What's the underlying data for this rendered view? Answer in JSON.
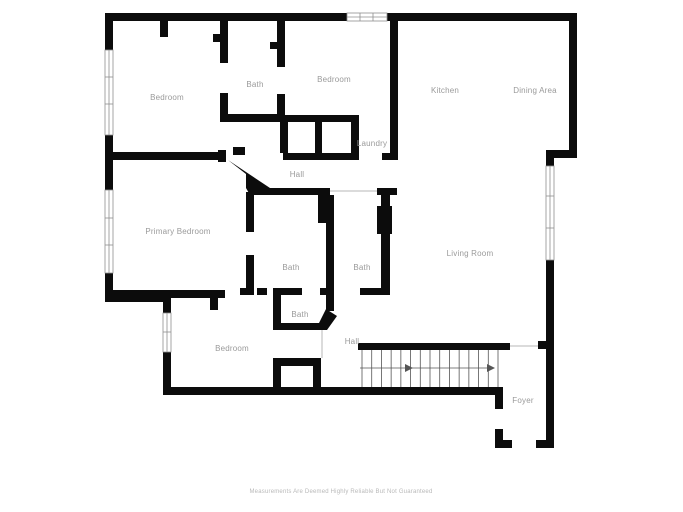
{
  "page": {
    "footer": "Measurements Are Deemed Highly Reliable But Not Guaranteed"
  },
  "colors": {
    "wall": "#0c0c0c",
    "label": "#9a9a9a",
    "window_frame": "#8f8f8f",
    "stair_line": "#555555",
    "background": "#ffffff"
  },
  "rooms": {
    "bedroom_top_left": "Bedroom",
    "bath_top": "Bath",
    "bedroom_top_middle": "Bedroom",
    "kitchen": "Kitchen",
    "dining_area": "Dining Area",
    "laundry": "Laundry",
    "hall_upper": "Hall",
    "primary_bedroom": "Primary Bedroom",
    "living_room": "Living Room",
    "bath_middle_left": "Bath",
    "bath_middle_right": "Bath",
    "bath_lower": "Bath",
    "bedroom_lower": "Bedroom",
    "hall_lower": "Hall",
    "foyer": "Foyer"
  },
  "stairs": {
    "tread_count": 14,
    "direction": "right"
  }
}
